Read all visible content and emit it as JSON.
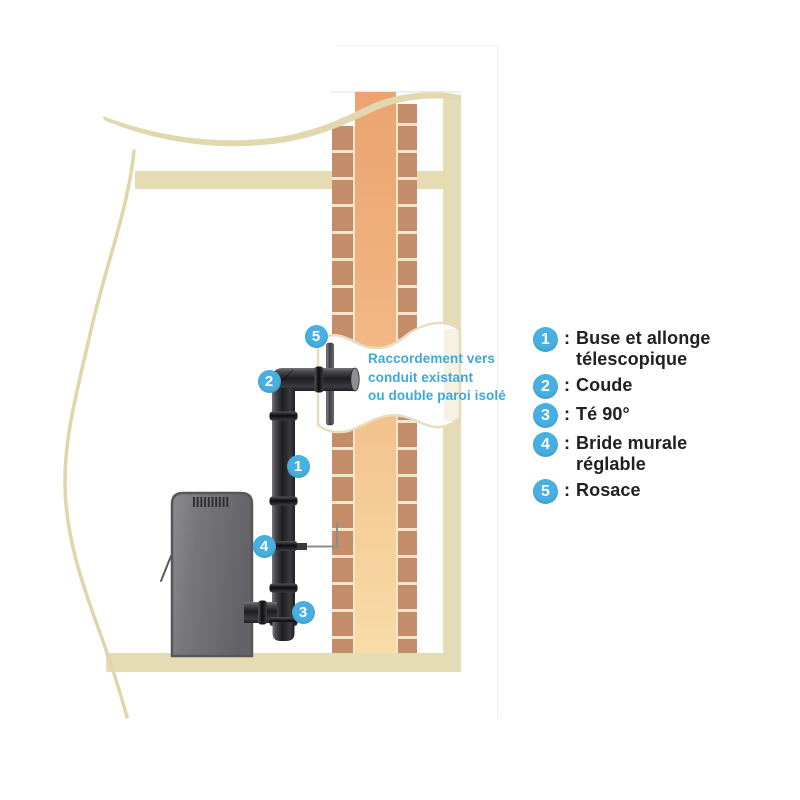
{
  "diagram": {
    "annotation_text": "Raccordement vers\nconduit existant\nou double paroi isolé",
    "markers": [
      {
        "number": "1"
      },
      {
        "number": "2"
      },
      {
        "number": "3"
      },
      {
        "number": "4"
      },
      {
        "number": "5"
      }
    ]
  },
  "legend": {
    "items": [
      {
        "number": "1",
        "separator": ":",
        "label": "Buse et allonge\ntélescopique"
      },
      {
        "number": "2",
        "separator": ":",
        "label": "Coude"
      },
      {
        "number": "3",
        "separator": ":",
        "label": "Té 90°"
      },
      {
        "number": "4",
        "separator": ":",
        "label": "Bride murale\nréglable"
      },
      {
        "number": "5",
        "separator": ":",
        "label": "Rosace"
      }
    ]
  },
  "colors": {
    "accent_blue": "#47AFE1",
    "annotation_blue": "#3CA9DC",
    "legend_text": "#232021",
    "wall_beige": "#E5DCB4",
    "brick": "#C48D69",
    "mortar": "#F1E6CB",
    "flue_dark": "#EBA470",
    "flue_light": "#F8DCA8",
    "pipe_black": "#1E1E21",
    "stove_gray": "#76767A"
  }
}
